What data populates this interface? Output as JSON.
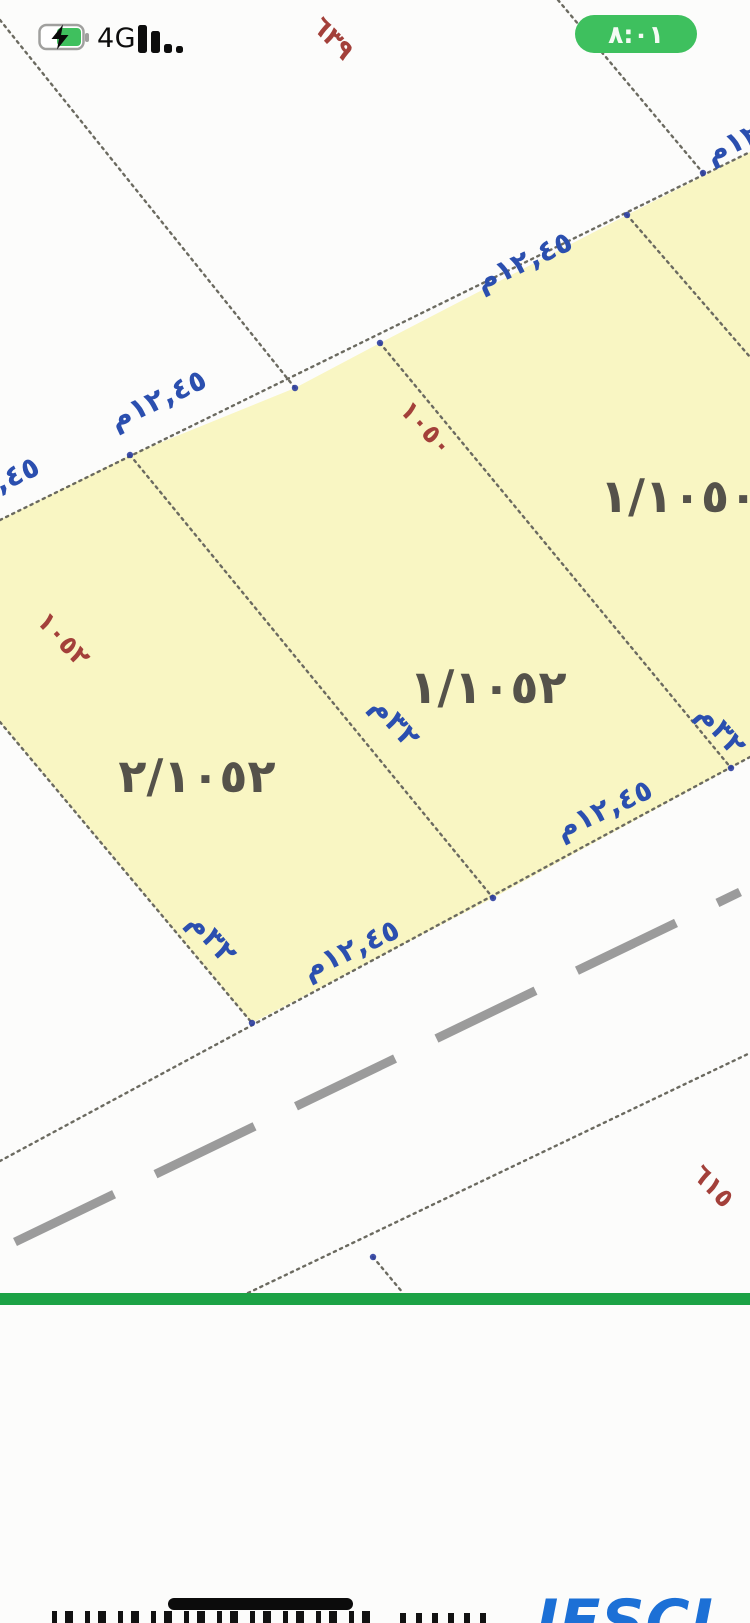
{
  "status_bar": {
    "network_label": "4G",
    "time": "٨:٠١"
  },
  "map": {
    "plots": {
      "left": "٢/١٠٥٢",
      "middle": "١/١٠٥٢",
      "right": "١/١٠٥٠"
    },
    "dimensions": {
      "frontage": "١٢,٤٥م",
      "depth": "٣٢م"
    },
    "red_numbers": {
      "top": "٦٣٩",
      "left": "١٠٥٢",
      "middle": "١٠٥٠",
      "bottom": "٦١٥"
    },
    "colors": {
      "parcel_fill": "#f9f6c3",
      "boundary_dots": "#6b6a60",
      "dimension_text": "#2b4faf",
      "red_text": "#a3403a",
      "plot_text": "#55524a",
      "divider_green": "#1ca245",
      "road_dash": "#9b9b9b",
      "pill_green": "#3ec05e"
    }
  },
  "footer": {
    "logo_fragment": "JESCI"
  }
}
